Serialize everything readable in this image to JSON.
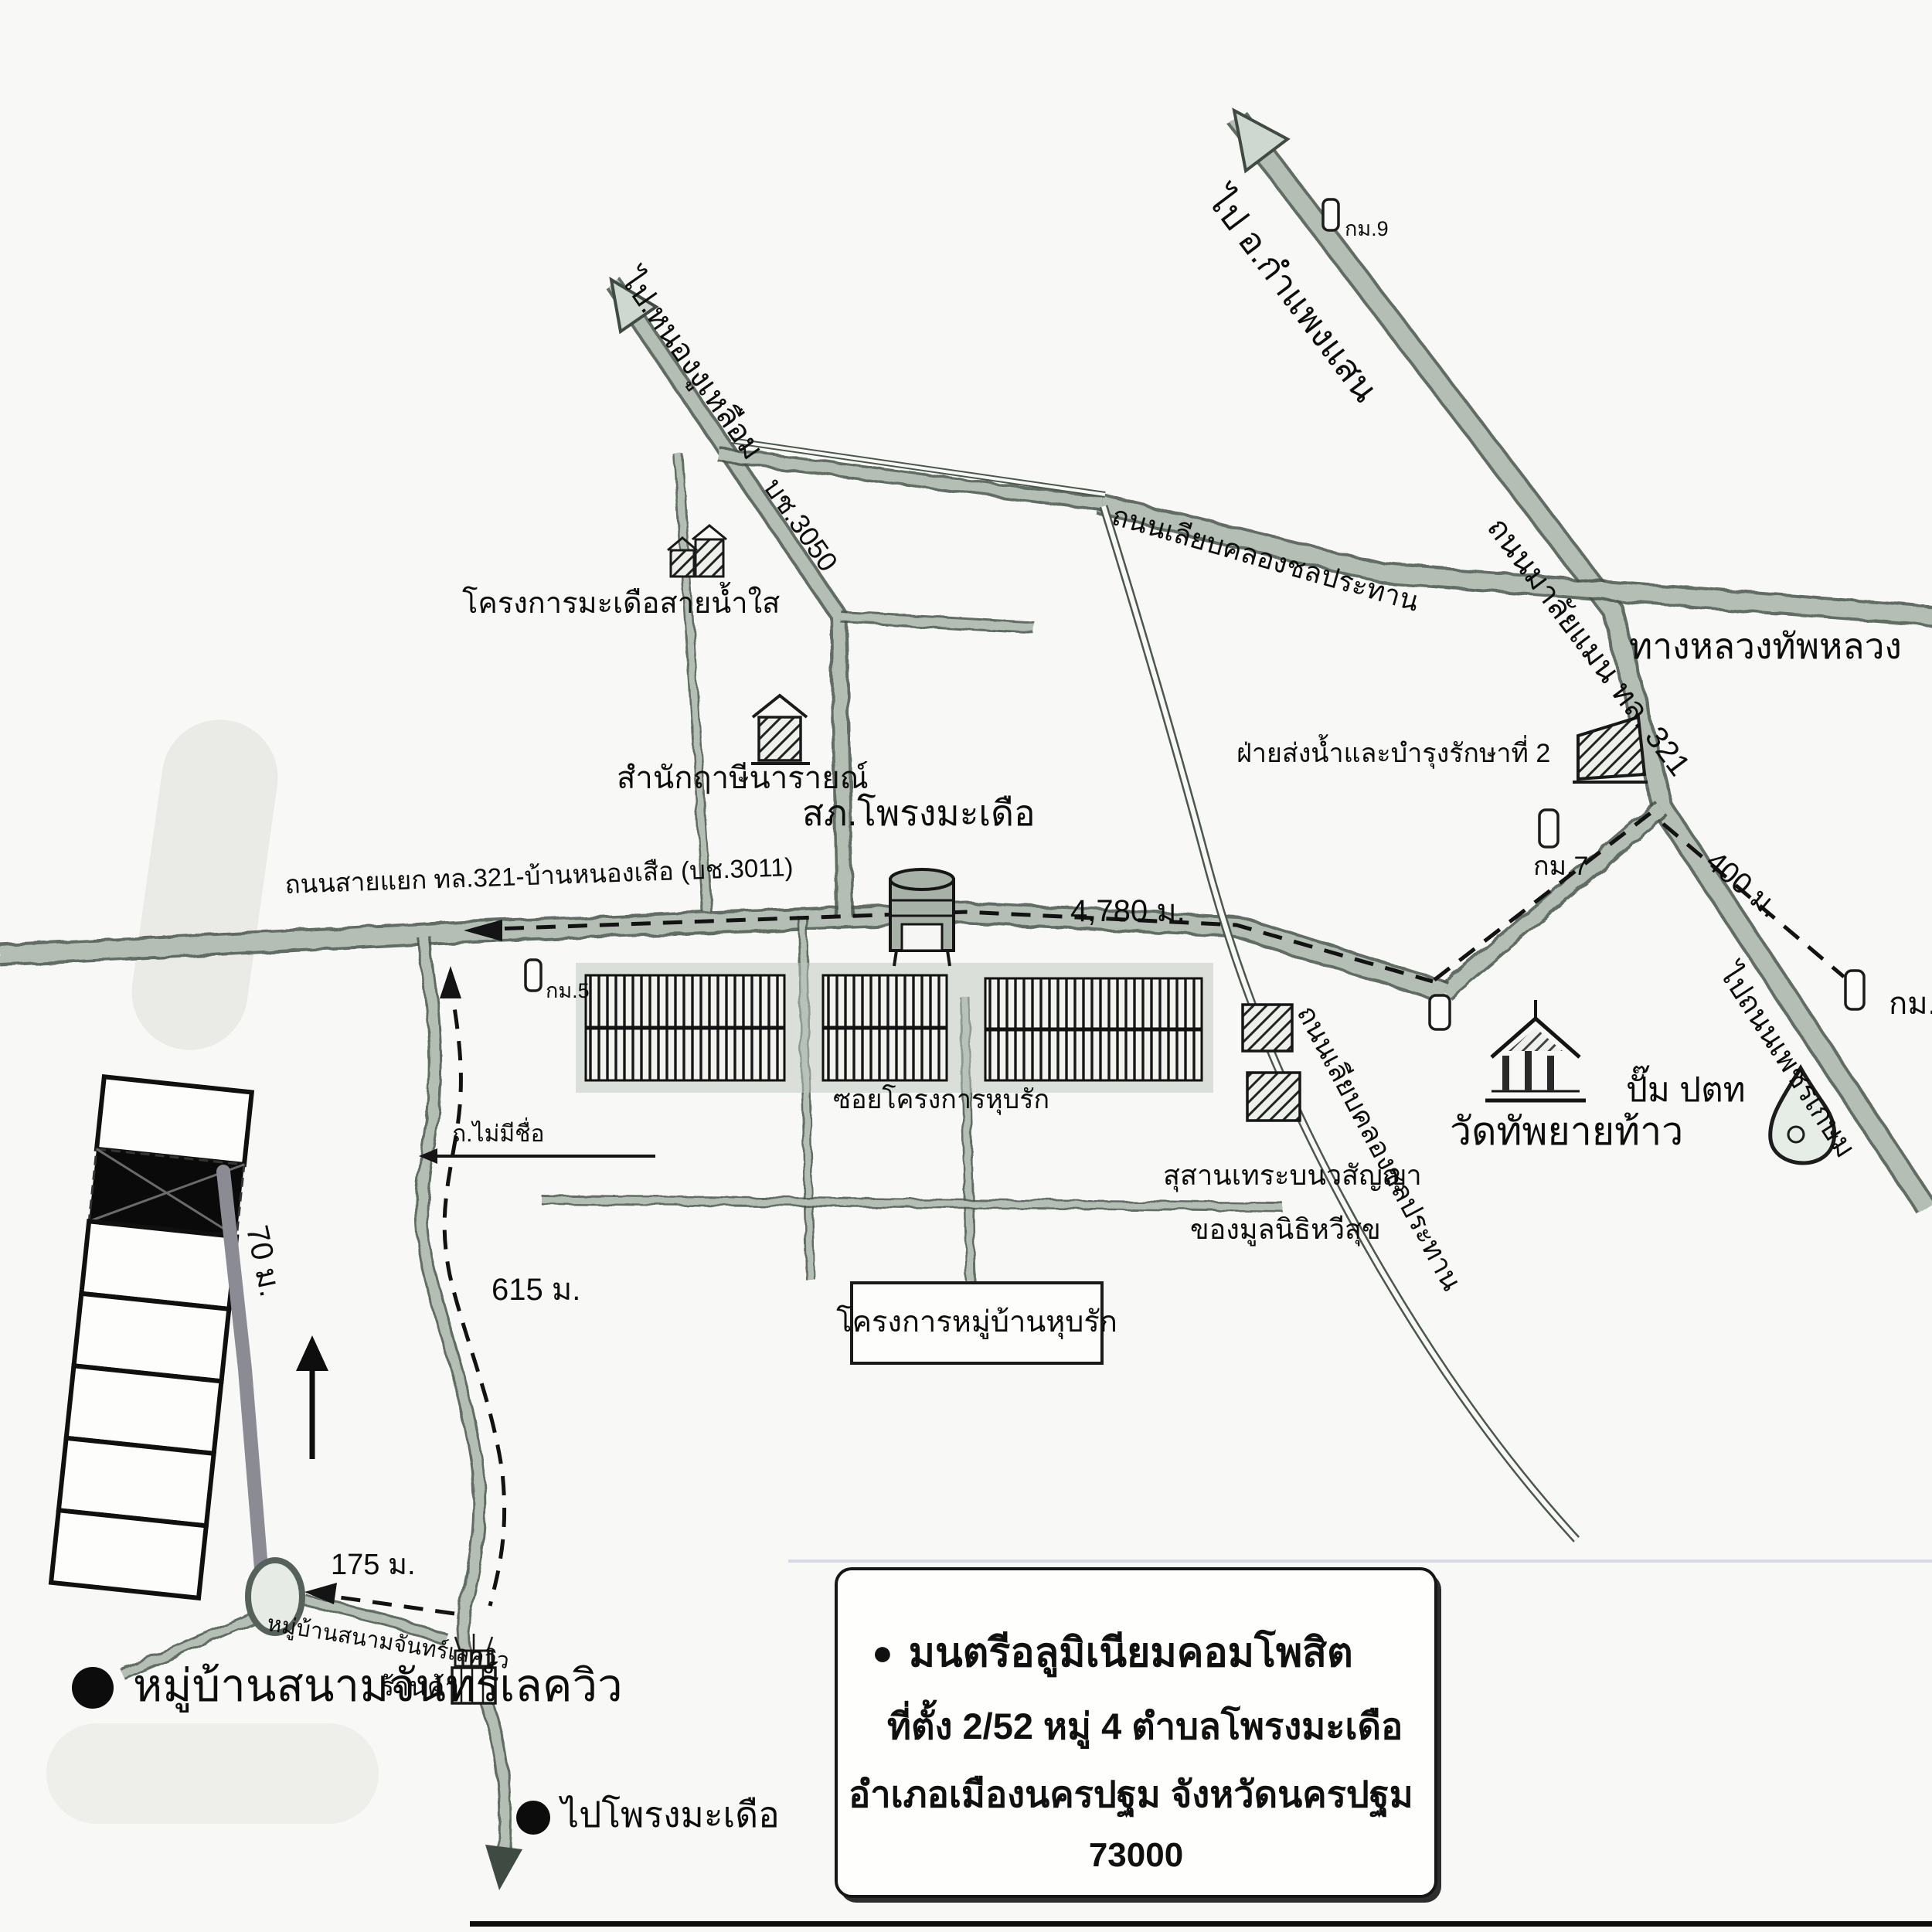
{
  "bullet": "●",
  "directions": {
    "kamphaeng_saen": "ไป อ.กำแพงแสน",
    "nong_ngu_lueam": "ไป.หนองงูเหลือม",
    "phetkasem": "ไปถนนเพชรเกษม",
    "phrong_madua": "ไปโพรงมะเดือ"
  },
  "roads": {
    "malaiman": "ถนนมาลัยแมน ทล. 321",
    "thap_luang": "ทางหลวงทัพหลวง",
    "branch_3011": "ถนนสายแยก ทล.321-บ้านหนองเสือ (บช.3011)",
    "canal": "ถนนเลียบคลองชลประทาน",
    "r3050": "บช.3050",
    "no_name": "ถ.ไม่มีชื่อ",
    "soi_hubrak": "ซอยโครงการหุบรัก"
  },
  "places": {
    "police": "สภ.โพรงมะเดือ",
    "madua_project": "โครงการมะเดือสายน้ำใส",
    "samnak": "สำนักฤาษีนารายณ์",
    "irrigation": "ฝ่ายส่งน้ำและบำรุงรักษาที่ 2",
    "wat": "วัดทัพยายท้าว",
    "ptt": "ปั๊ม ปตท",
    "cemetery_line1": "สุสานเทระบนวสัญญา",
    "cemetery_line2": "ของมูลนิธิหวีสุข",
    "shop": "ร้านค้า",
    "village_on_road": "หมู่บ้านสนามจันทร์เลควิว",
    "village_big": "หมู่บ้านสนามจันทร์เลควิว",
    "hubrak_project": "โครงการหมู่บ้านหุบรัก"
  },
  "distances": {
    "d4780": "4,780 ม.",
    "d615": "615 ม.",
    "d175": "175 ม.",
    "d70": "70 ม.",
    "d400": "400 ม."
  },
  "milestones": {
    "km5": "กม.5",
    "km7": "กม.7",
    "km8": "กม.8",
    "km9": "กม.9"
  },
  "info": {
    "name": "มนตรีอลูมิเนียมคอมโพสิต",
    "addr1": "ที่ตั้ง 2/52  หมู่ 4  ตำบลโพรงมะเดือ",
    "addr2": "อำเภอเมืองนครปฐม จังหวัดนครปฐม",
    "postal": "73000"
  },
  "colors": {
    "road": "#b4beb5",
    "road_edge": "#47534a",
    "canal": "#4a574d",
    "route_dash": "#121212",
    "plot_highlight": "#0a0a0a",
    "access_road_gray": "#8b8b94",
    "background": "#f8f8f6"
  }
}
